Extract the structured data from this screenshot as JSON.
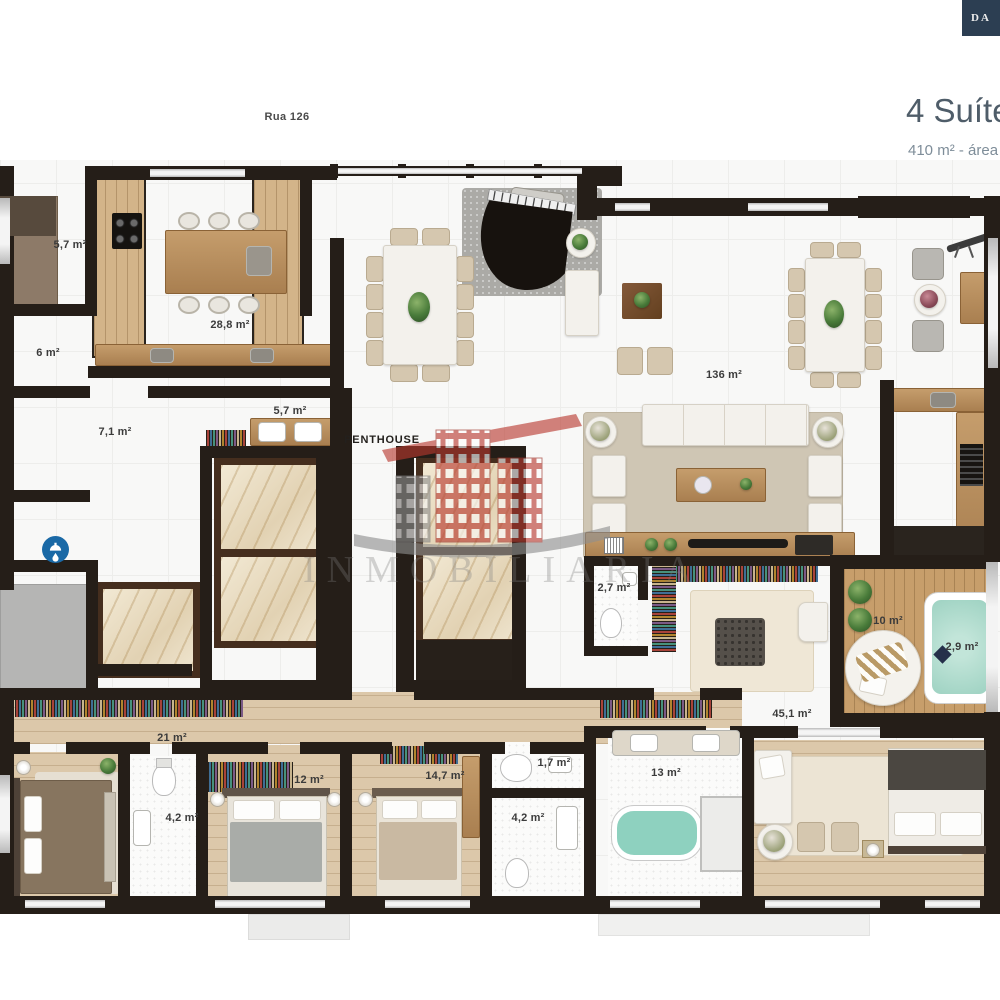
{
  "header": {
    "brand_badge": "DA",
    "title": "4 Suítes",
    "subtitle": "410 m² - área",
    "street": "Rua 126"
  },
  "plan": {
    "penthouse": "PENTHOUSE",
    "areas": {
      "pantry": "5,7 m²",
      "kitchen": "28,8 m²",
      "service": "6 m²",
      "hall": "7,1 m²",
      "support": "5,7 m²",
      "living": "136 m²",
      "lavabo": "2,7 m²",
      "terrace": "10 m²",
      "spa": "2,9 m²",
      "study": "45,1 m²",
      "suite1": "21 m²",
      "suite2": "12 m²",
      "suite3": "14,7 m²",
      "bath1": "4,2 m²",
      "bath2": "1,7 m²",
      "master_bath": "13 m²",
      "bath3": "4,2 m²"
    }
  },
  "watermark": {
    "name": "INMOBILIARIA"
  },
  "colors": {
    "wall": "#251e18",
    "brand_navy": "#2c3e52",
    "title_text": "#4f5d69",
    "watermark_red": "#b8382e",
    "spa_water": "#9ed2c2",
    "badge_blue": "#1a69a6"
  }
}
